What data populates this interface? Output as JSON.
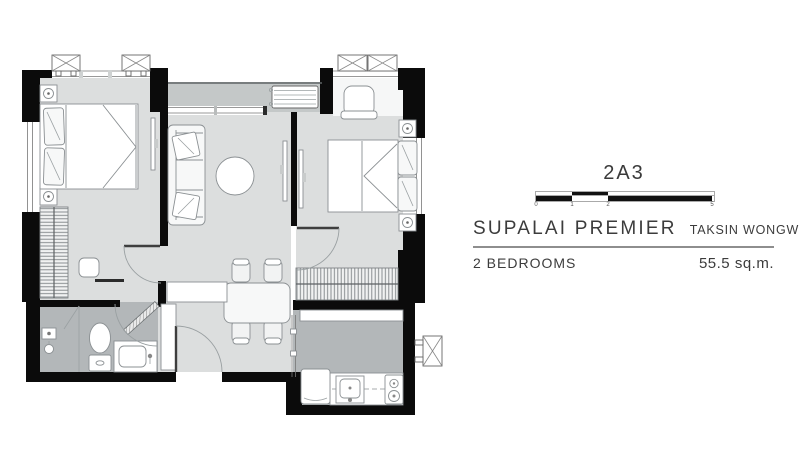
{
  "panel": {
    "unit_code": "2A3",
    "project_name": "SUPALAI PREMIER",
    "location": "TAKSIN WONGWIANYAI",
    "bedrooms_label": "2 BEDROOMS",
    "area_label": "55.5 sq.m.",
    "scale": {
      "ticks": [
        "0",
        "1",
        "2",
        "5"
      ]
    }
  },
  "colors": {
    "wall": "#0b0b0b",
    "floor_light": "#dcdede",
    "floor_balcony": "#c4c8c8",
    "floor_wet": "#b3b7b9",
    "line": "#8b9093"
  }
}
